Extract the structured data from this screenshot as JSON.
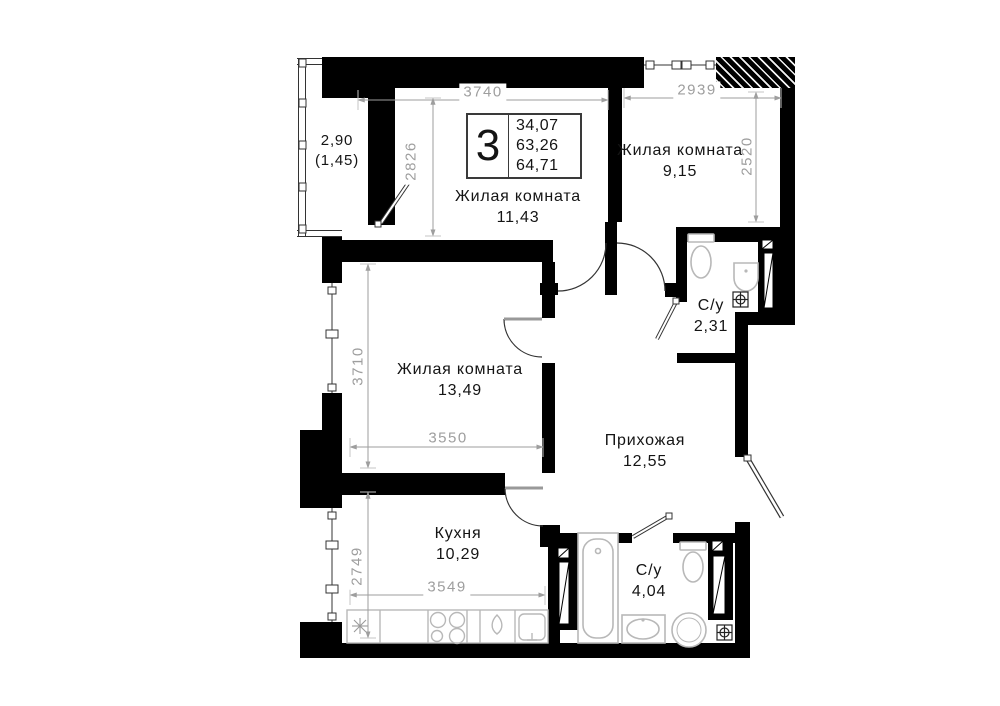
{
  "colors": {
    "wall": "#000000",
    "dimension": "#9e9e9e",
    "label": "#141414",
    "fixture": "#b8b8b8"
  },
  "info_box": {
    "room_count": "3",
    "areas": [
      "34,07",
      "63,26",
      "64,71"
    ]
  },
  "rooms": {
    "balcony": {
      "area": "2,90",
      "area_reduced": "(1,45)"
    },
    "living_top": {
      "name": "Жилая комната",
      "area": "11,43"
    },
    "living_right": {
      "name": "Жилая комната",
      "area": "9,15"
    },
    "living_mid": {
      "name": "Жилая комната",
      "area": "13,49"
    },
    "hallway": {
      "name": "Прихожая",
      "area": "12,55"
    },
    "kitchen": {
      "name": "Кухня",
      "area": "10,29"
    },
    "bathroom_small": {
      "name": "С/у",
      "area": "2,31"
    },
    "bathroom_large": {
      "name": "С/у",
      "area": "4,04"
    }
  },
  "dimensions_mm": {
    "living_top_width": "3740",
    "living_top_depth": "2826",
    "living_right_width": "2939",
    "living_right_depth": "2520",
    "living_mid_depth": "3710",
    "living_mid_width": "3550",
    "kitchen_depth": "2749",
    "kitchen_width": "3549"
  }
}
